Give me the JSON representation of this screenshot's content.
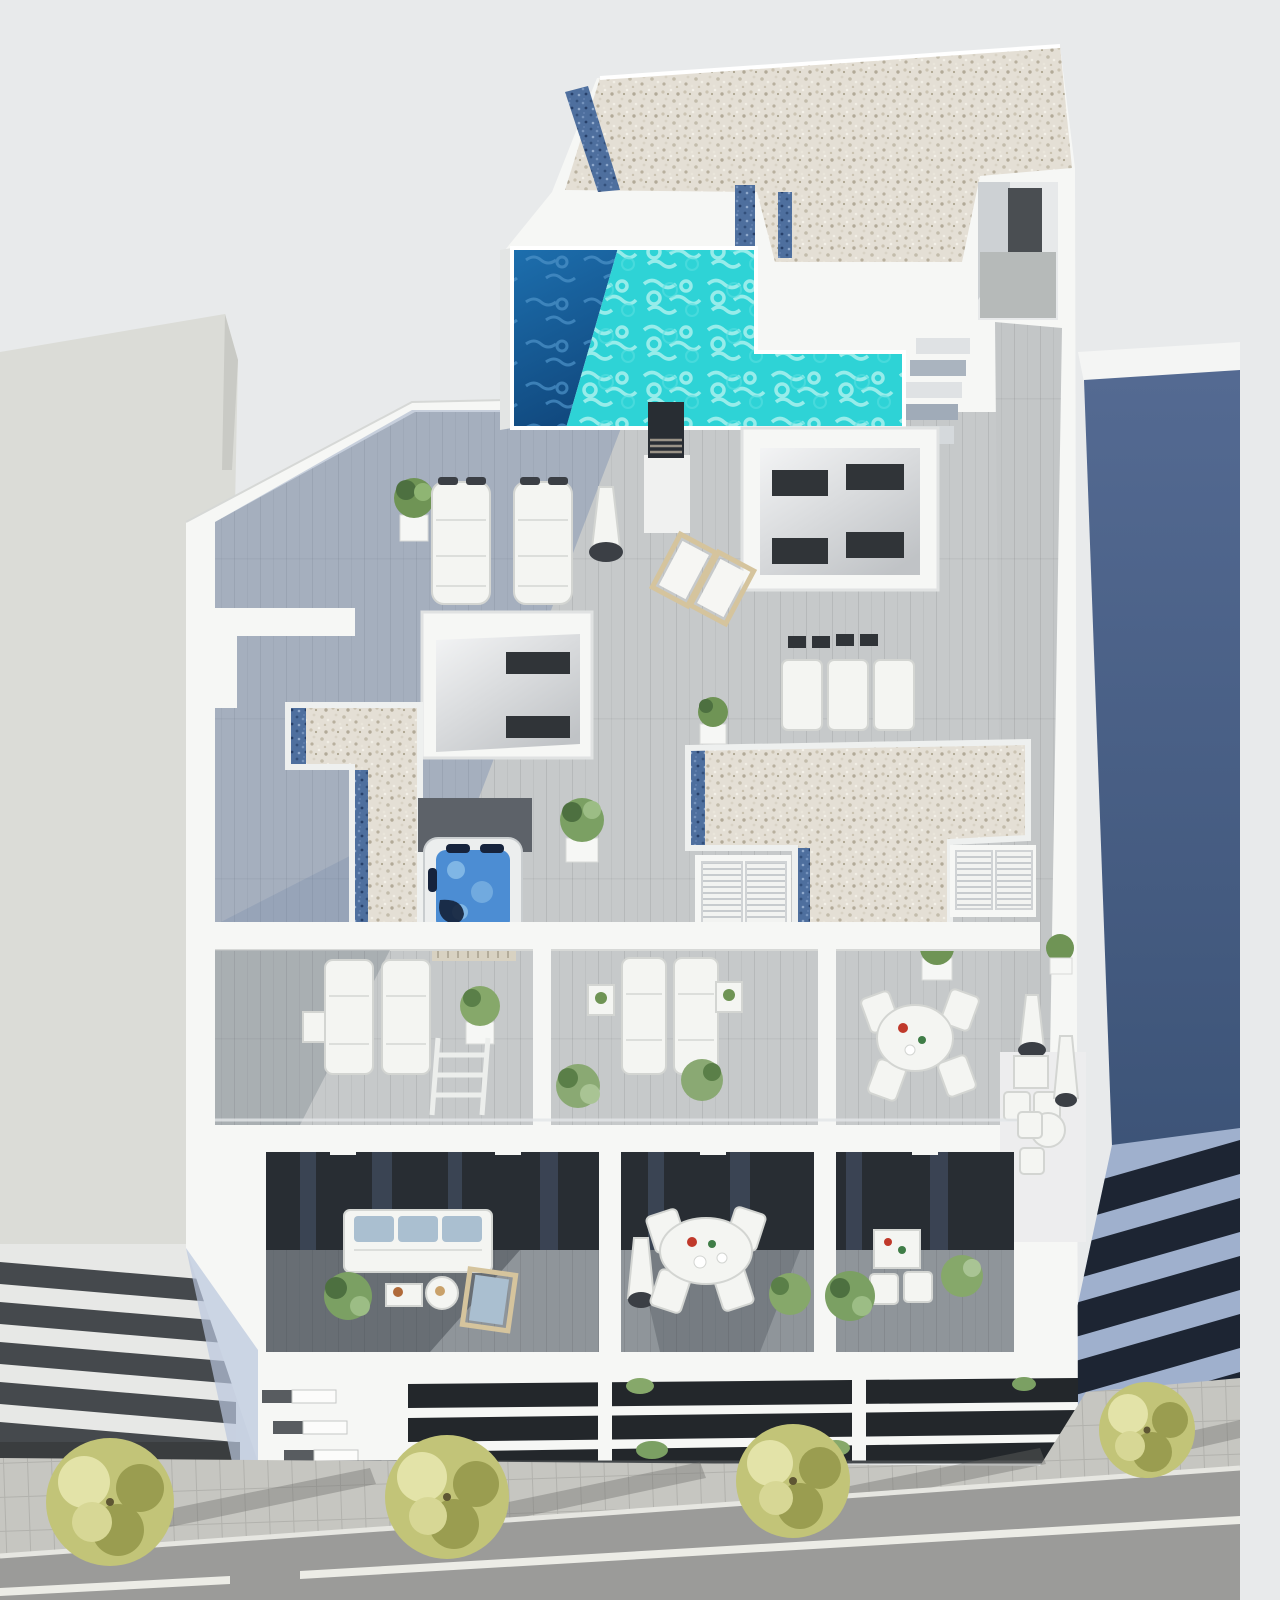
{
  "scene": {
    "subject": "aerial-3d-rendering-residential-building-roof-terraces",
    "colors": {
      "sky": "#e8eaeb",
      "building_white": "#f6f7f5",
      "building_shade": "#dfe2e2",
      "left_roof": "#dbdcd7",
      "left_band_dark": "#45494d",
      "gravel_base": "#e4dfd5",
      "gravel_blue": "#4e6f9e",
      "deck_wood": "#c6c9ca",
      "deck_shadow": "#5a74a1",
      "terrace_floor": "#8f959a",
      "pool_water": "#2ed3d6",
      "pool_deep_top": "#1d6fae",
      "pool_deep_bottom": "#114a80",
      "hot_tub_water": "#4c8dd3",
      "glass_dark": "#282d33",
      "glass_reflection": "#50607a",
      "neighbor_wall_top": "#546a92",
      "neighbor_wall_bottom": "#3d5478",
      "neighbor_band_light": "#9fb0cd",
      "neighbor_band_dark": "#1d2533",
      "street": "#9b9b99",
      "sidewalk": "#c6c6c1",
      "road_line": "#ecece6",
      "tree_foliage": "#c2c478",
      "tree_light": "#e3e3a8",
      "tree_dark": "#9a9d50",
      "plant_green": "#6f9455",
      "plant_dark": "#4d7040",
      "wood_furniture": "#d5c49d",
      "cushion_blue": "#aabfd0",
      "metal_dark": "#3b3f45"
    },
    "objects": {
      "rooftop_pool": 1,
      "hot_tub": 1,
      "gravel_roofs": 3,
      "lightwells": 2,
      "stairwell": 1,
      "padded_sun_loungers": 2,
      "flat_loungers": 3,
      "wooden_deck_chairs": 2,
      "middle_terraces": 3,
      "terrace_sun_loungers": 4,
      "balconies": 3,
      "parasols": 4,
      "round_dining_tables": 3,
      "sofa": 1,
      "potted_plants": 14,
      "street_trees": 4,
      "neighbor_buildings": 2
    }
  }
}
